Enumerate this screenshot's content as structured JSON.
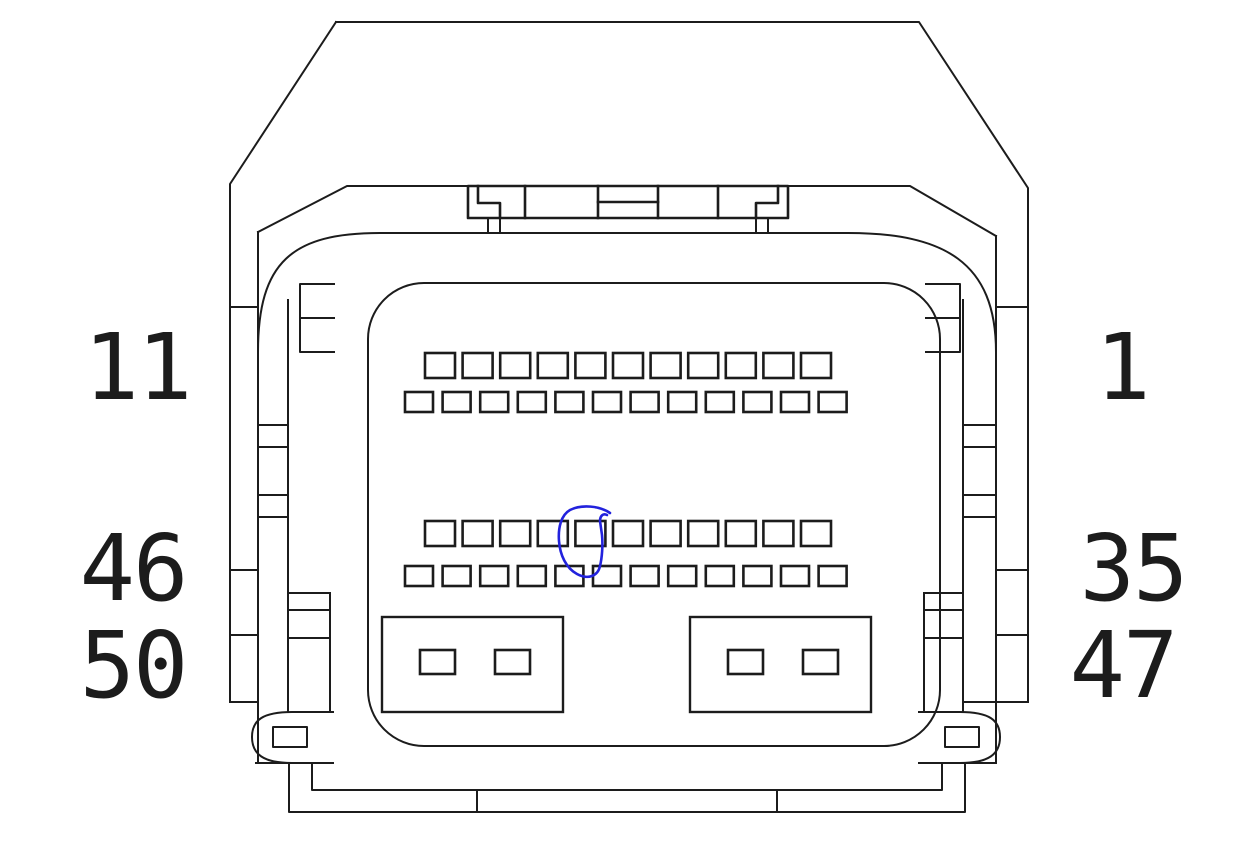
{
  "drawing": {
    "type": "connector-pinout-diagram",
    "description": "Front face line drawing of a multi-pin automotive connector with numbered pin rows and one pin circled in blue ink",
    "background": "#ffffff",
    "line_color": "#1c1c1c",
    "annotation_color": "#2222dd",
    "labels": [
      {
        "name": "pin-label-top-left",
        "text": "11",
        "x": 137,
        "y": 399
      },
      {
        "name": "pin-label-top-right",
        "text": "1",
        "x": 1122,
        "y": 399
      },
      {
        "name": "pin-label-mid-left",
        "text": "46",
        "x": 133,
        "y": 600
      },
      {
        "name": "pin-label-bottom-left",
        "text": "50",
        "x": 133,
        "y": 697
      },
      {
        "name": "pin-label-mid-right",
        "text": "35",
        "x": 1133,
        "y": 600
      },
      {
        "name": "pin-label-bottom-right",
        "text": "47",
        "x": 1123,
        "y": 697
      }
    ],
    "pin_rows": [
      {
        "name": "row-pins-1-11",
        "count": 11,
        "x": 425,
        "y": 353,
        "w": 30,
        "h": 25,
        "pitch": 37.6
      },
      {
        "name": "row-pins-12-23",
        "count": 12,
        "x": 405,
        "y": 392,
        "w": 28,
        "h": 20,
        "pitch": 37.6
      },
      {
        "name": "row-pins-24-34",
        "count": 11,
        "x": 425,
        "y": 521,
        "w": 30,
        "h": 25,
        "pitch": 37.6
      },
      {
        "name": "row-pins-35-46",
        "count": 12,
        "x": 405,
        "y": 566,
        "w": 28,
        "h": 20,
        "pitch": 37.6
      }
    ],
    "power_blocks": [
      {
        "name": "power-block-left",
        "x": 382,
        "y": 617,
        "w": 181,
        "h": 95,
        "pins": [
          {
            "x": 420,
            "y": 650,
            "w": 35,
            "h": 24
          },
          {
            "x": 495,
            "y": 650,
            "w": 35,
            "h": 24
          }
        ]
      },
      {
        "name": "power-block-right",
        "x": 690,
        "y": 617,
        "w": 181,
        "h": 95,
        "pins": [
          {
            "x": 728,
            "y": 650,
            "w": 35,
            "h": 24
          },
          {
            "x": 803,
            "y": 650,
            "w": 35,
            "h": 24
          }
        ]
      }
    ],
    "annotation": {
      "name": "blue-ink-circle",
      "circled_row": "row-pins-24-34",
      "circled_pin_index_from_left": 5,
      "style": "freehand pen loop with open hook at top right"
    }
  }
}
